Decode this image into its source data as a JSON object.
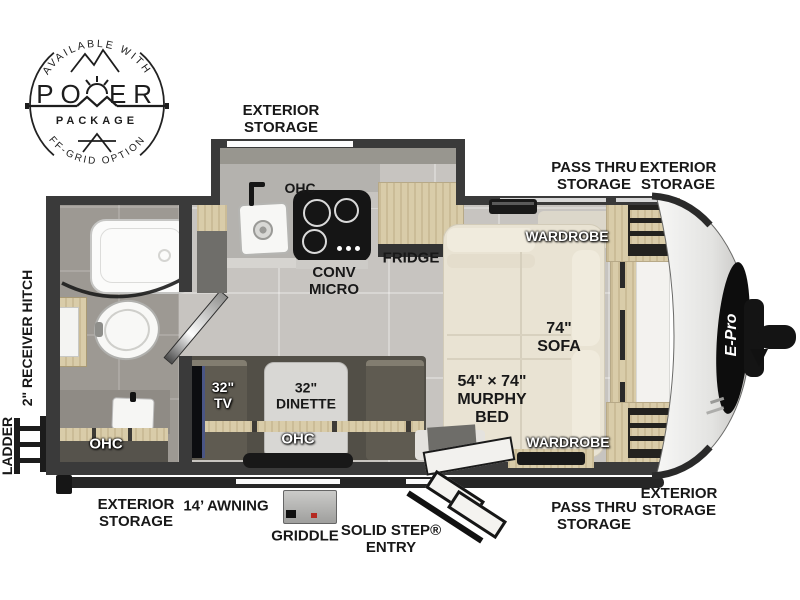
{
  "badge": {
    "top_arc": "AVAILABLE WITH",
    "word_left": "PO",
    "word_right": "ER",
    "subtitle": "PACKAGE",
    "bottom_arc": "OFF-GRID OPTIONS"
  },
  "labels": {
    "top_storage": "EXTERIOR\nSTORAGE",
    "pass_thru_top": "PASS THRU\nSTORAGE",
    "exterior_top_right": "EXTERIOR\nSTORAGE",
    "receiver_hitch": "2\" RECEIVER HITCH",
    "ladder": "LADDER",
    "exterior_bottom_left": "EXTERIOR\nSTORAGE",
    "awning": "14’ AWNING",
    "griddle": "GRIDDLE",
    "solid_step_entry": "SOLID STEP®\nENTRY",
    "pass_thru_bottom": "PASS THRU\nSTORAGE",
    "exterior_bottom_right": "EXTERIOR\nSTORAGE"
  },
  "rooms": {
    "kitchen_ohc": "OHC",
    "conv_micro": "CONV\nMICRO",
    "fridge": "FRIDGE",
    "wardrobe_top": "WARDROBE",
    "sofa": "74\"\nSOFA",
    "murphy_bed": "54\" × 74\"\nMURPHY\nBED",
    "wardrobe_bottom": "WARDROBE",
    "tv": "32\"\nTV",
    "dinette": "32\"\nDINETTE",
    "dinette_ohc": "OHC",
    "bath_ohc": "OHC"
  },
  "front_decal": "E-Pro",
  "colors": {
    "wall": "#3a3a3a",
    "floor": "#c7c4c0",
    "bath_floor": "#9d9993",
    "wood": "#d9cca9",
    "sofa_cream": "#e9e3d3",
    "label_black": "#161616"
  }
}
